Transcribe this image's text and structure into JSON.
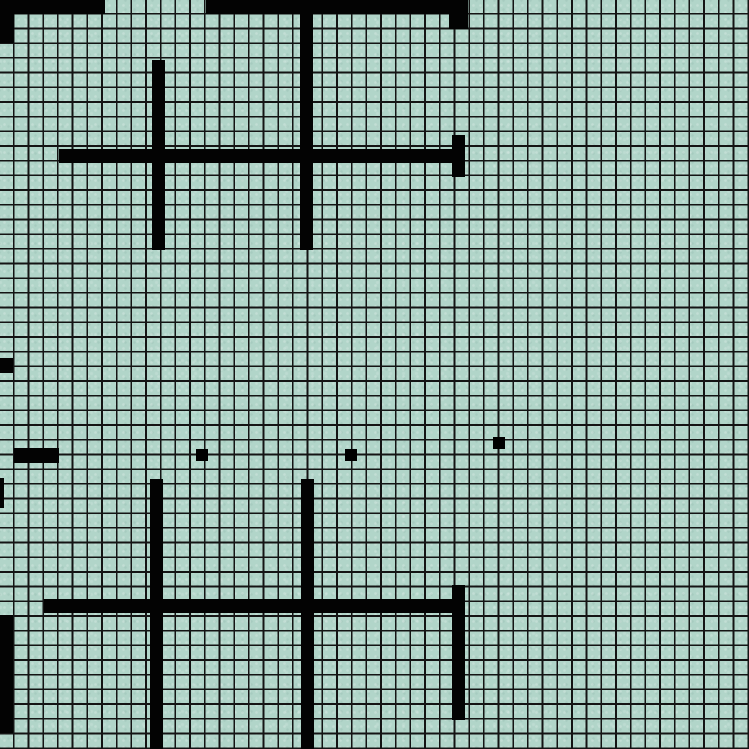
{
  "map": {
    "width_px": 749,
    "height_px": 749,
    "tile_color": "#b1d5c9",
    "grid": {
      "columns": 51,
      "rows": 51,
      "cell_size_px": 14.686,
      "first_line_offset_px": 13.0,
      "line_width_px": 1.7,
      "line_color": "#141414"
    },
    "wall_color": "#030303",
    "dot_color": "#000000",
    "walls": [
      {
        "name": "top-edge-band-left",
        "x": 0,
        "y": 0,
        "w": 105,
        "h": 14
      },
      {
        "name": "top-edge-band-right",
        "x": 206,
        "y": 0,
        "w": 262,
        "h": 14
      },
      {
        "name": "left-edge-top-block",
        "x": 0,
        "y": 0,
        "w": 14,
        "h": 43
      },
      {
        "name": "top-right-notch",
        "x": 449,
        "y": 14,
        "w": 19,
        "h": 15
      },
      {
        "name": "upper-cross-main-vertical",
        "x": 300,
        "y": 0,
        "w": 13,
        "h": 250
      },
      {
        "name": "upper-cross-left-vertical",
        "x": 152,
        "y": 60,
        "w": 13,
        "h": 190
      },
      {
        "name": "upper-cross-horizontal",
        "x": 59,
        "y": 149,
        "w": 393,
        "h": 14
      },
      {
        "name": "upper-cross-right-cap",
        "x": 452,
        "y": 135,
        "w": 13,
        "h": 42
      },
      {
        "name": "left-edge-mid-cell",
        "x": 0,
        "y": 358,
        "w": 13,
        "h": 15
      },
      {
        "name": "left-mid-segment",
        "x": 14,
        "y": 448,
        "w": 45,
        "h": 15
      },
      {
        "name": "left-edge-sliver",
        "x": 0,
        "y": 478,
        "w": 4,
        "h": 30
      },
      {
        "name": "left-edge-bottom-strip",
        "x": 0,
        "y": 615,
        "w": 13,
        "h": 118
      },
      {
        "name": "lower-cross-left-vertical",
        "x": 150,
        "y": 479,
        "w": 13,
        "h": 270
      },
      {
        "name": "lower-cross-main-vertical",
        "x": 301,
        "y": 479,
        "w": 13,
        "h": 270
      },
      {
        "name": "lower-cross-horizontal",
        "x": 44,
        "y": 599,
        "w": 421,
        "h": 14
      },
      {
        "name": "lower-cross-right-cap",
        "x": 452,
        "y": 585,
        "w": 13,
        "h": 135
      }
    ],
    "dots": [
      {
        "name": "map-dot-1",
        "x": 196,
        "y": 449,
        "w": 12,
        "h": 12
      },
      {
        "name": "map-dot-2",
        "x": 345,
        "y": 449,
        "w": 12,
        "h": 12
      },
      {
        "name": "map-dot-3",
        "x": 493,
        "y": 437,
        "w": 12,
        "h": 12
      }
    ]
  }
}
